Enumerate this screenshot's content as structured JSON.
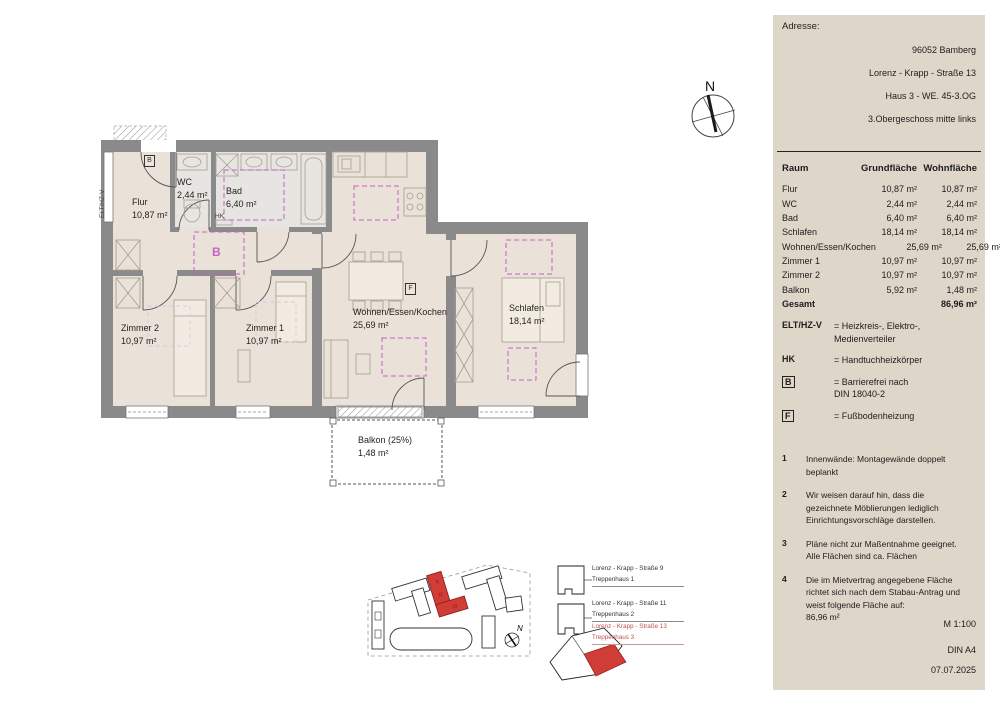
{
  "panel": {
    "address": {
      "label": "Adresse:",
      "lines": [
        "96052 Bamberg",
        "Lorenz - Krapp - Straße 13",
        "Haus 3 - WE. 45-3.OG",
        "3.Obergeschoss mitte links"
      ]
    },
    "table": {
      "headers": [
        "Raum",
        "Grundfläche",
        "Wohnfläche"
      ],
      "rows": [
        {
          "raum": "Flur",
          "grund": "10,87 m²",
          "wohn": "10,87 m²"
        },
        {
          "raum": "WC",
          "grund": "2,44 m²",
          "wohn": "2,44 m²"
        },
        {
          "raum": "Bad",
          "grund": "6,40 m²",
          "wohn": "6,40 m²"
        },
        {
          "raum": "Schlafen",
          "grund": "18,14 m²",
          "wohn": "18,14 m²"
        },
        {
          "raum": "Wohnen/Essen/Kochen",
          "grund": "25,69 m²",
          "wohn": "25,69 m²"
        },
        {
          "raum": "Zimmer 1",
          "grund": "10,97 m²",
          "wohn": "10,97 m²"
        },
        {
          "raum": "Zimmer 2",
          "grund": "10,97 m²",
          "wohn": "10,97 m²"
        },
        {
          "raum": "Balkon",
          "grund": "5,92 m²",
          "wohn": "1,48 m²"
        }
      ],
      "total": {
        "raum": "Gesamt",
        "grund": "",
        "wohn": "86,96 m²"
      }
    },
    "legend": [
      {
        "key": "ELT/HZ-V",
        "text": "= Heizkreis-, Elektro-,\nMedienverteiler"
      },
      {
        "key": "HK",
        "text": "= Handtuchheizkörper"
      },
      {
        "key": "B",
        "text": "= Barrierefrei nach\nDIN 18040-2"
      },
      {
        "key": "F",
        "text": "= Fußbodenheizung"
      }
    ],
    "notes": [
      {
        "num": "1",
        "text": "Innenwände: Montagewände doppelt\nbeplankt"
      },
      {
        "num": "2",
        "text": "Wir weisen darauf hin, dass die\ngezeichnete Möblierungen lediglich\nEinrichtungsvorschläge darstellen."
      },
      {
        "num": "3",
        "text": "Pläne nicht zur Maßentnahme geeignet.\nAlle Flächen sind ca. Flächen"
      },
      {
        "num": "4",
        "text": "Die im Mietvertrag angegebene Fläche\nrichtet sich nach dem Stabau-Antrag und\nweist folgende Fläche auf:\n86,96 m²"
      }
    ],
    "scale": "M 1:100",
    "format": "DIN A4",
    "date": "07.07.2025"
  },
  "plan": {
    "rooms": [
      {
        "name": "Flur",
        "area": "10,87 m²"
      },
      {
        "name": "WC",
        "area": "2,44 m²"
      },
      {
        "name": "Bad",
        "area": "6,40 m²"
      },
      {
        "name": "Zimmer 2",
        "area": "10,97 m²"
      },
      {
        "name": "Zimmer 1",
        "area": "10,97 m²"
      },
      {
        "name": "Wohnen/Essen/Kochen",
        "area": "25,69 m²"
      },
      {
        "name": "Schlafen",
        "area": "18,14 m²"
      },
      {
        "name": "Balkon (25%)",
        "area": "1,48 m²"
      }
    ],
    "markers": {
      "barrier_box": "B",
      "floorheating_box": "F",
      "barrier_area": "B",
      "towel_radiator": "HK",
      "distributor": "ELT/HZ-V"
    }
  },
  "compass": {
    "label": "N"
  },
  "siteplan": {
    "entries": [
      {
        "street": "Lorenz - Krapp - Straße 9",
        "house": "Treppenhaus 1"
      },
      {
        "street": "Lorenz - Krapp - Straße 11",
        "house": "Treppenhaus 2"
      },
      {
        "street": "Lorenz - Krapp - Straße 13",
        "house": "Treppenhaus 3"
      }
    ],
    "building_numbers": [
      "9",
      "11",
      "13"
    ],
    "north_label": "N"
  },
  "colors": {
    "panel_bg": "#ded6c9",
    "floor": "#eae2d8",
    "bath_floor": "#e7e5e2",
    "wall": "#8a8a8a",
    "magenta": "#c65fc6",
    "highlight_red": "#d03c36",
    "highlight_text": "#c0504d"
  }
}
